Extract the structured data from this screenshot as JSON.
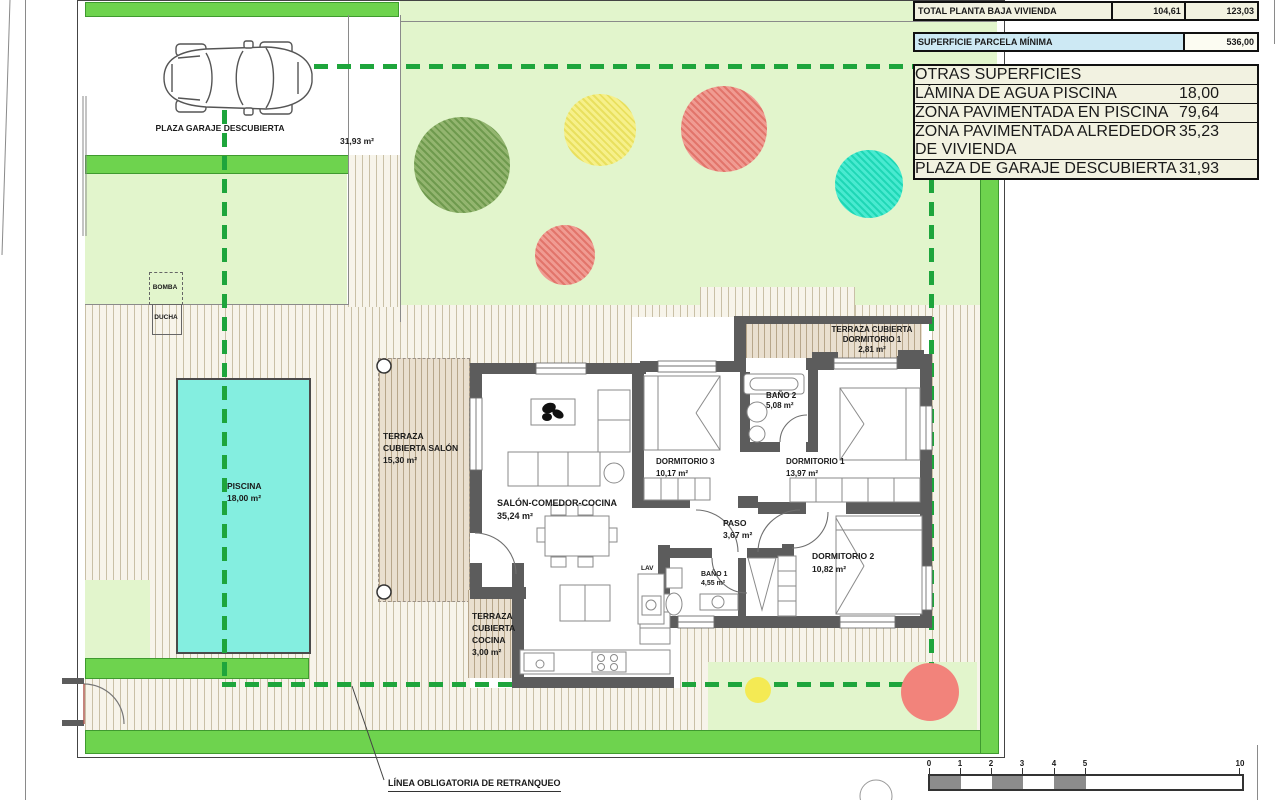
{
  "summary_table": {
    "total_row": {
      "label": "TOTAL PLANTA BAJA VIVIENDA",
      "value1": "104,61",
      "value2": "123,03"
    },
    "parcela_row": {
      "label": "SUPERFICIE PARCELA MÍNIMA",
      "value": "536,00"
    },
    "otras": {
      "header": "OTRAS SUPERFICIES",
      "rows": [
        {
          "label": "LÁMINA DE AGUA PISCINA",
          "value": "18,00"
        },
        {
          "label": "ZONA PAVIMENTADA EN PISCINA",
          "value": "79,64"
        },
        {
          "label": "ZONA PAVIMENTADA ALREDEDOR DE VIVIENDA",
          "value": "35,23"
        },
        {
          "label": "PLAZA DE GARAJE DESCUBIERTA",
          "value": "31,93"
        }
      ]
    }
  },
  "areas": {
    "garage": {
      "name": "PLAZA GARAJE DESCUBIERTA",
      "area": "31,93 m²"
    },
    "piscina": {
      "name": "PISCINA",
      "area": "18,00 m²"
    },
    "bomba": "BOMBA",
    "ducha": "DUCHA",
    "lav": "LAV",
    "terraza_salon": {
      "line1": "TERRAZA",
      "line2": "CUBIERTA SALÓN",
      "area": "15,30 m²"
    },
    "terraza_cocina": {
      "line1": "TERRAZA",
      "line2": "CUBIERTA",
      "line3": "COCINA",
      "area": "3,00 m²"
    },
    "terraza_dorm1": {
      "line1": "TERRAZA CUBIERTA",
      "line2": "DORMITORIO 1",
      "area": "2,81 m²"
    },
    "salon": {
      "name": "SALÓN-COMEDOR-COCINA",
      "area": "35,24 m²"
    },
    "dorm1": {
      "name": "DORMITORIO 1",
      "area": "13,97 m²"
    },
    "dorm2": {
      "name": "DORMITORIO 2",
      "area": "10,82 m²"
    },
    "dorm3": {
      "name": "DORMITORIO 3",
      "area": "10,17 m²"
    },
    "bano1": {
      "name": "BAÑO 1",
      "area": "4,55 m²"
    },
    "bano2": {
      "name": "BAÑO 2",
      "area": "5,08 m²"
    },
    "paso": {
      "name": "PASO",
      "area": "3,67 m²"
    }
  },
  "annotations": {
    "setback": "LÍNEA OBLIGATORIA DE RETRANQUEO"
  },
  "scale_bar": {
    "ticks": [
      "0",
      "1",
      "2",
      "3",
      "4",
      "5",
      "10"
    ]
  },
  "colors": {
    "garden": "#e2f5cc",
    "hedge": "#6ed34e",
    "pool": "#84eee0",
    "setback_dash": "#1ea53c",
    "wall": "#5c5c5c",
    "tree_green": "#85a862",
    "tree_yellow": "#f2ea74",
    "tree_red": "#ec897f",
    "tree_teal": "#35e0bf",
    "table_blue": "#cde9f4",
    "table_cream": "#f2f2e1"
  }
}
